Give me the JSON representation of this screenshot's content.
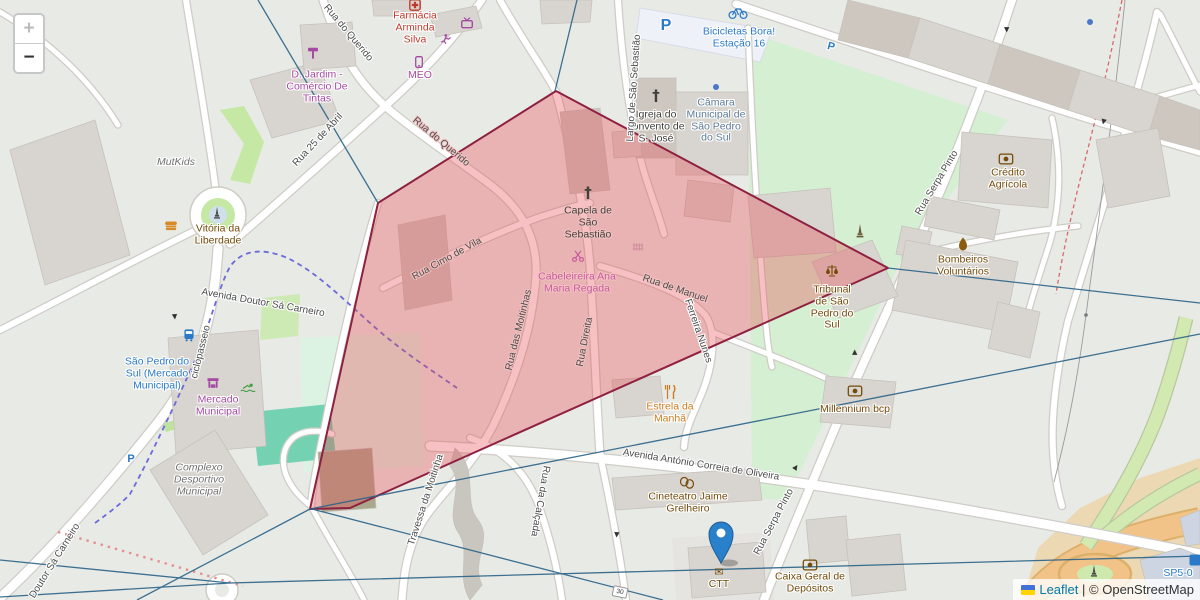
{
  "controls": {
    "zoom_in": "+",
    "zoom_out": "−"
  },
  "attribution": {
    "leaflet": "Leaflet",
    "sep": "|",
    "osm": "© OpenStreetMap"
  },
  "labels": {
    "farmacia": "Farmácia Arminda Silva",
    "meo": "MEO",
    "d_jardim": "D. Jardim - Comércio De Tintas",
    "bicicletas": "Bicicletas Bora! Estação 16",
    "igreja": "Igreja do convento de S. José",
    "camara": "Câmara Municipal de São Pedro do Sul",
    "capela": "Capela de São Sebastião",
    "cabeleireira": "Cabeleireira Ana Maria Regada",
    "tribunal": "Tribunal de São Pedro do Sul",
    "credito": "Crédito Agrícola",
    "bombeiros": "Bombeiros Voluntários",
    "millennium": "Millennium bcp",
    "estrela": "Estrela da Manhã",
    "cineteatro": "Cineteatro Jaime Grelheiro",
    "ctt": "CTT",
    "caixa": "Caixa Geral de Depósitos",
    "mercado": "Mercado Municipal",
    "sao_pedro": "São Pedro do Sul (Mercado Municipal)",
    "mutkids": "MutKids",
    "vitoria": "Vitória da Liberdade",
    "complexo": "Complexo Desportivo Municipal",
    "parking": "P",
    "speed30": "30",
    "sp5": "SP5-0"
  },
  "streets": {
    "querido1": "Rua do Querido",
    "querido2": "Rua do Querido",
    "abril": "Rua 25 de Abril",
    "largo": "Largo de São Sebastião",
    "cimo": "Rua Cimo de Vila",
    "moitinhas": "Rua das Moitinhas",
    "direita": "Rua Direita",
    "manuel1": "Rua de Manuel",
    "manuel2": "Ferreira Nunes",
    "serpa1": "Rua Serpa Pinto",
    "serpa2": "Rua Serpa Pinto",
    "antonio": "Avenida António Correia de Oliveira",
    "ciclo": "ciclopasseio",
    "av_doutor": "Avenida Doutor Sá Carneiro",
    "doutor": "Doutor Sá Carneiro",
    "travessa": "Travessa da Moitinha",
    "calcada": "Rua da Calçada"
  },
  "icons": {
    "pharmacy": "red-cross-box",
    "tv": "tv",
    "runner": "running-person",
    "phone": "mobile-phone",
    "paint_roller": "paint-roller",
    "bike": "bicycle",
    "church_cross": "†",
    "envelope": "✉",
    "scales": "justice-scales",
    "flame": "fire-flame",
    "bank": "money-box",
    "fork": "fork-knife",
    "masks": "theatre-masks",
    "bus": "bus",
    "market": "market-stall",
    "burger": "fast-food",
    "swimmer": "swimmer",
    "monument": "monument-obelisk",
    "gate": "pink-gate-grid",
    "marker": "map-pin"
  },
  "colors": {
    "polygon_fill": "#e84850",
    "polygon_stroke": "#8e2140",
    "overlay_line": "#2e6589",
    "marker_blue": "#2a81cb",
    "link_blue": "#0078a8",
    "transit_blue": "#2a79c7",
    "shop_purple": "#a549a3",
    "amenity_brown": "#734a08",
    "health_red": "#bf3a2b",
    "field_green": "#d5efd2",
    "road_orange": "#f2c389"
  }
}
